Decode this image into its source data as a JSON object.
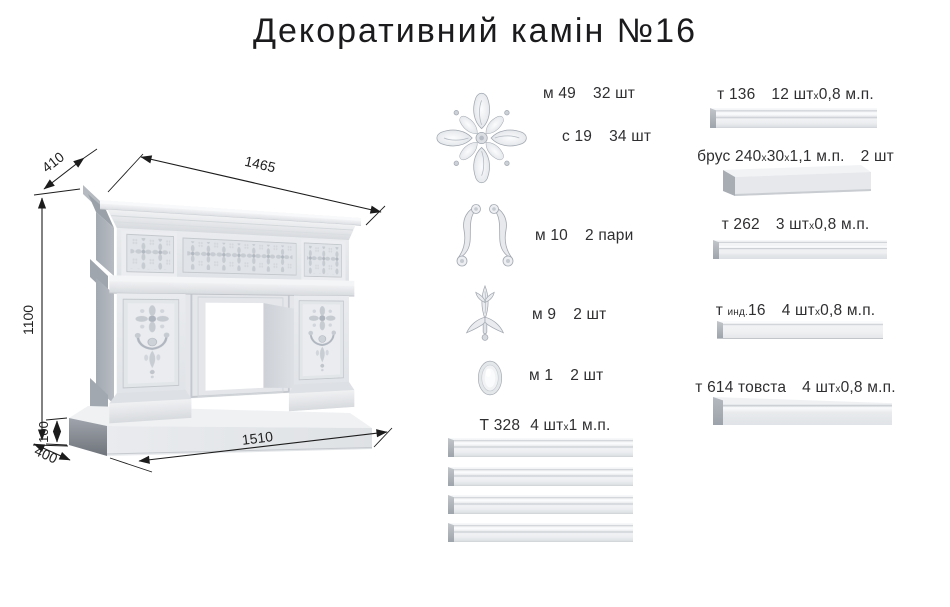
{
  "page": {
    "title": "Декоративний камін №16"
  },
  "drawing": {
    "dims": {
      "mantel_width": "1465",
      "mantel_depth": "410",
      "height": "1100",
      "base_height": "100",
      "base_depth": "400",
      "base_width": "1510"
    }
  },
  "ornaments": [
    {
      "code": "м 49",
      "qty": "32 шт"
    },
    {
      "code": "с 19",
      "qty": "34 шт"
    },
    {
      "code": "м 10",
      "qty": "2 пари"
    },
    {
      "code": "м 9",
      "qty": "2 шт"
    },
    {
      "code": "м 1",
      "qty": "2 шт"
    }
  ],
  "moldings": {
    "t328": {
      "code": "Т 328",
      "qty": "4 штх1 м.п."
    },
    "right_column": [
      {
        "code": "т 136",
        "qty": "12 штх0,8 м.п."
      },
      {
        "code": "брус 240х30х1,1 м.п.",
        "qty": "2 шт"
      },
      {
        "code": "т 262",
        "qty": "3 штх0,8 м.п."
      },
      {
        "code": "т инд.16",
        "qty": "4 штх0,8 м.п."
      },
      {
        "code": "т 614 товста",
        "qty": "4 штх0,8 м.п."
      }
    ]
  },
  "colors": {
    "ink": "#1c1c1c",
    "label": "#2f2f31",
    "render_light": "#eef0f2",
    "render_mid": "#c9cdd2",
    "render_dark": "#9aa0a8"
  }
}
